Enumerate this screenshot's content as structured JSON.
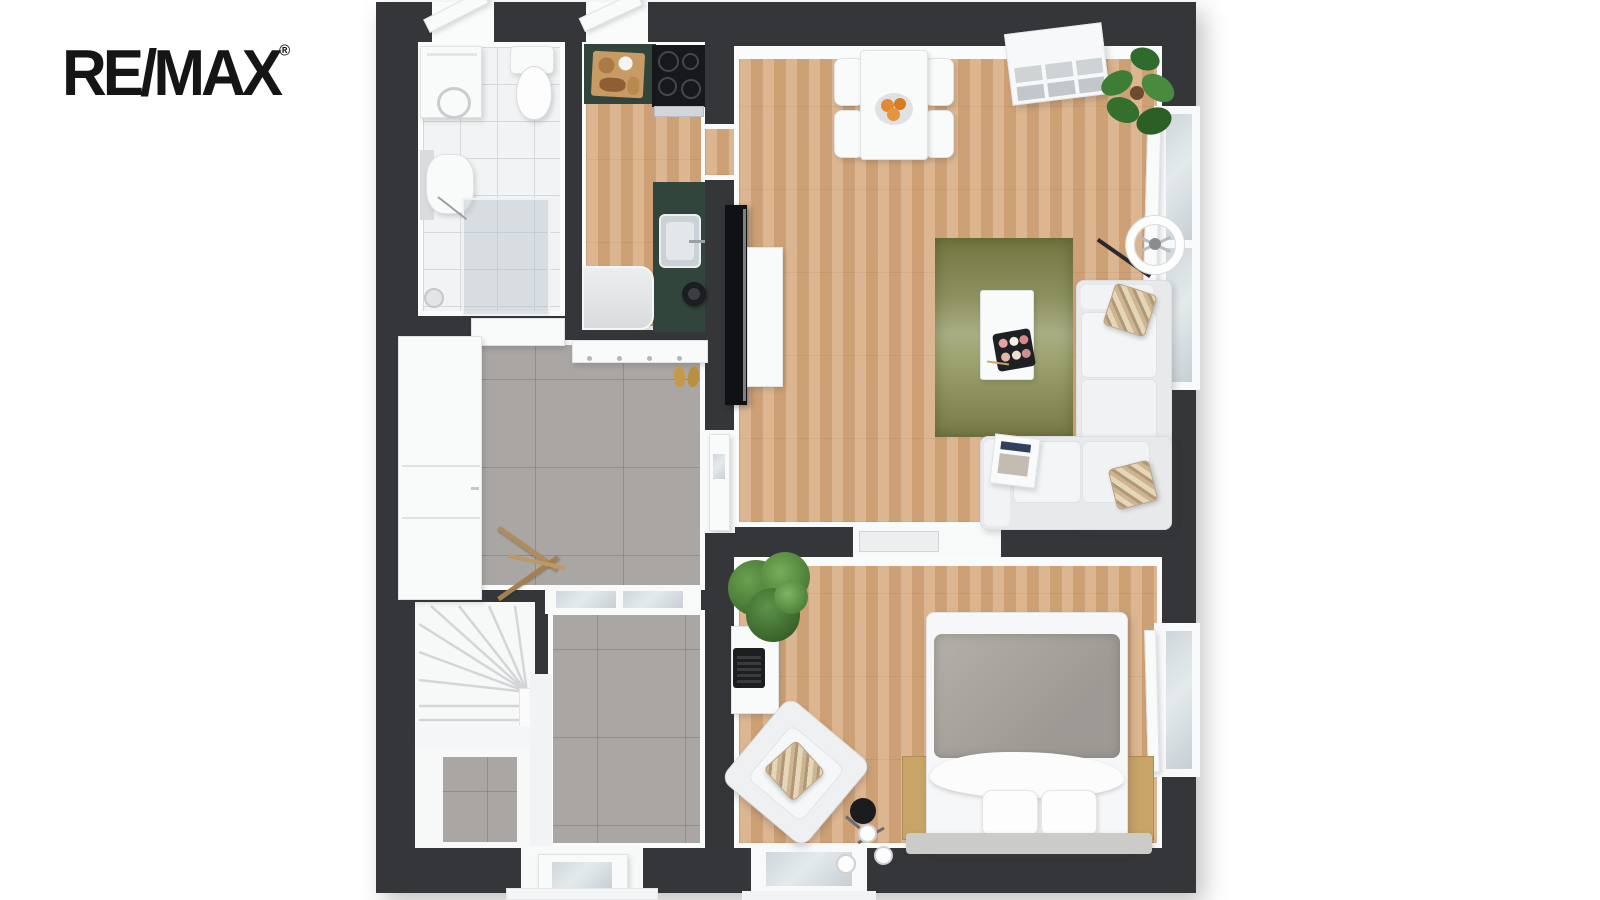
{
  "brand": {
    "logo_text": "RE/MAX",
    "registered_mark": "®"
  },
  "floor_plan": {
    "view": "top-down 3d apartment floor plan",
    "palette": {
      "wall": "#35363a",
      "wood_floor": "#d2a77d",
      "tile_gray": "#a9a6a3",
      "tile_white": "#f1f3f4",
      "kitchen_counter_green": "#32453c",
      "rug_olive": "#8d9161",
      "duvet_gray": "#a7a39e",
      "orange_fruit": "#e08a33",
      "plant_green": "#4a7c35",
      "slipper_tan": "#c49a4a"
    },
    "rooms": [
      {
        "id": "bathroom",
        "furniture": [
          "washing-machine",
          "toilet",
          "wash-basin",
          "shower-enclosure"
        ]
      },
      {
        "id": "kitchen",
        "furniture": [
          "green-countertop",
          "cutting-board",
          "cooktop",
          "kitchen-sink",
          "kettle",
          "fridge"
        ]
      },
      {
        "id": "living-dining",
        "furniture": [
          "dining-table",
          "four-chairs",
          "fruit-bowl",
          "cube-shelf",
          "monstera-plant",
          "ring-floor-lamp",
          "tv",
          "tv-board",
          "olive-rug",
          "coffee-table",
          "sushi-tray",
          "corner-sofa",
          "striped-cushions",
          "magazine"
        ]
      },
      {
        "id": "hallway",
        "furniture": [
          "wardrobe",
          "coat-rack",
          "slippers",
          "folding-stand"
        ]
      },
      {
        "id": "stairs",
        "furniture": [
          "winder-staircase"
        ]
      },
      {
        "id": "entry",
        "furniture": [
          "front-door",
          "glass-partition"
        ]
      },
      {
        "id": "bedroom",
        "furniture": [
          "double-bed",
          "pillows",
          "wood-nightstands",
          "bench",
          "desk",
          "typewriter",
          "armchair",
          "bulb-floor-lamp",
          "tree-plant"
        ]
      }
    ]
  }
}
